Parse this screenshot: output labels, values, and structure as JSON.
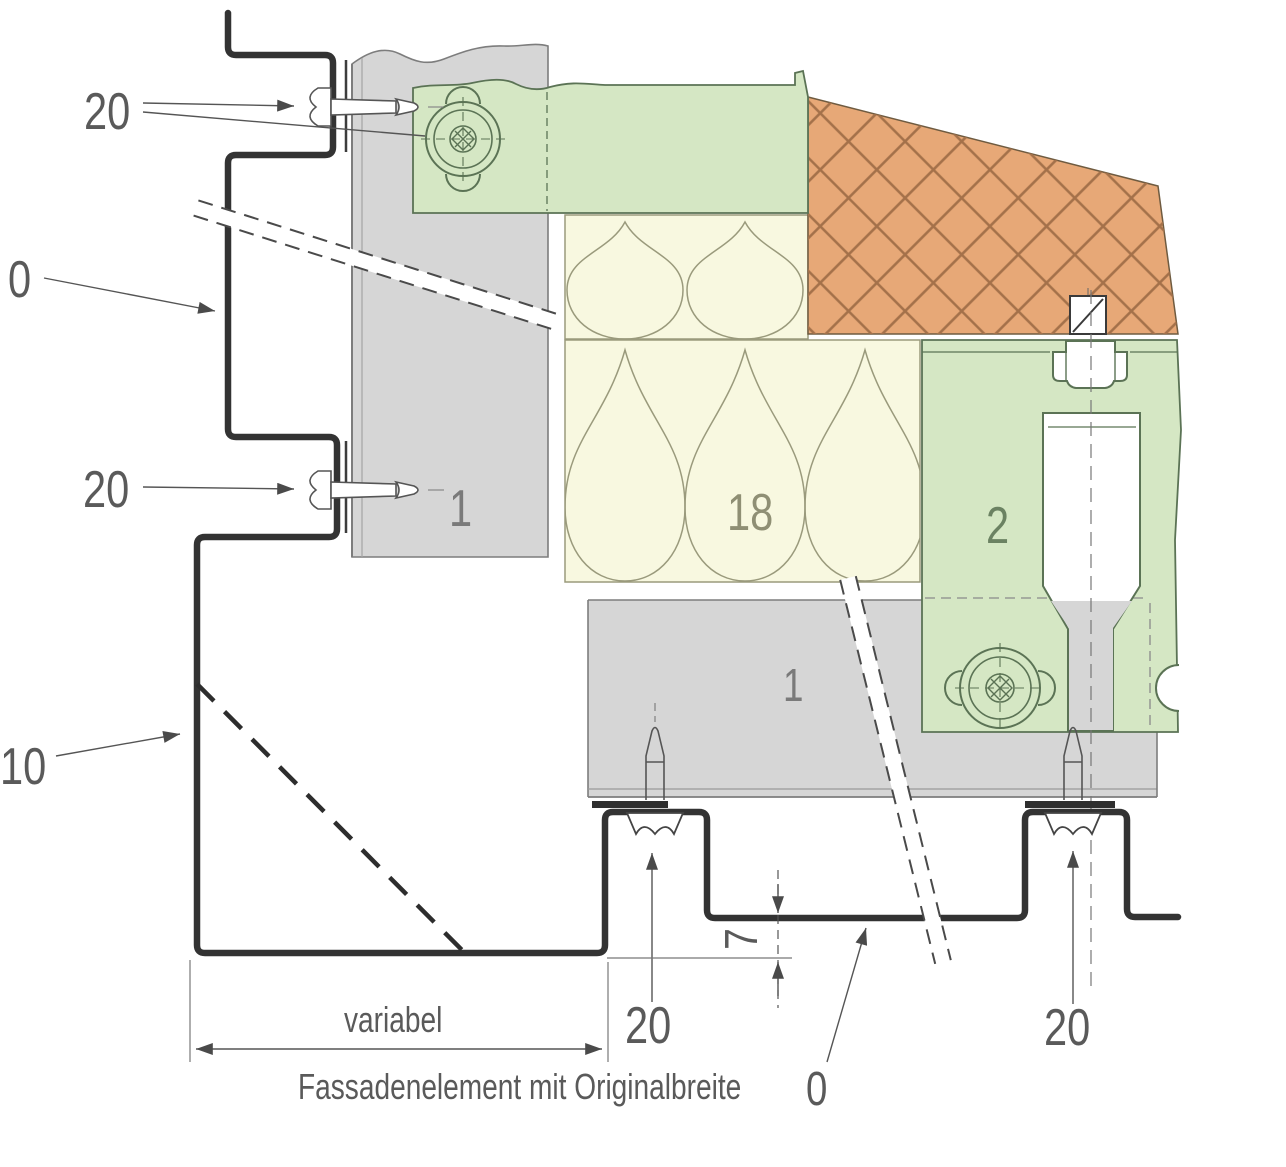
{
  "labels": {
    "fastener_top": "20",
    "element_ref_top": "0",
    "fastener_mid": "20",
    "element_ref_mid": "10",
    "panel_top": "1",
    "insulation": "18",
    "bracket": "2",
    "panel_bottom": "1",
    "step_depth": "7",
    "fastener_bottom_left": "20",
    "fastener_bottom_right": "20",
    "width_dim": "variabel",
    "caption": "Fassadenelement mit Originalbreite",
    "caption_ref": "0"
  },
  "colors": {
    "green": "#d5e7c4",
    "green_line": "#5b7355",
    "brick": "#e7a877",
    "brick_line": "#a4714a",
    "brick_edge": "#6f5b40",
    "insul": "#f8f8e0",
    "insul_line": "#9a9a7c",
    "panel": "#d6d6d6",
    "panel_line": "#7d7d7d",
    "profile": "#333333",
    "text": "#5a5a5a",
    "thin": "#555555"
  }
}
